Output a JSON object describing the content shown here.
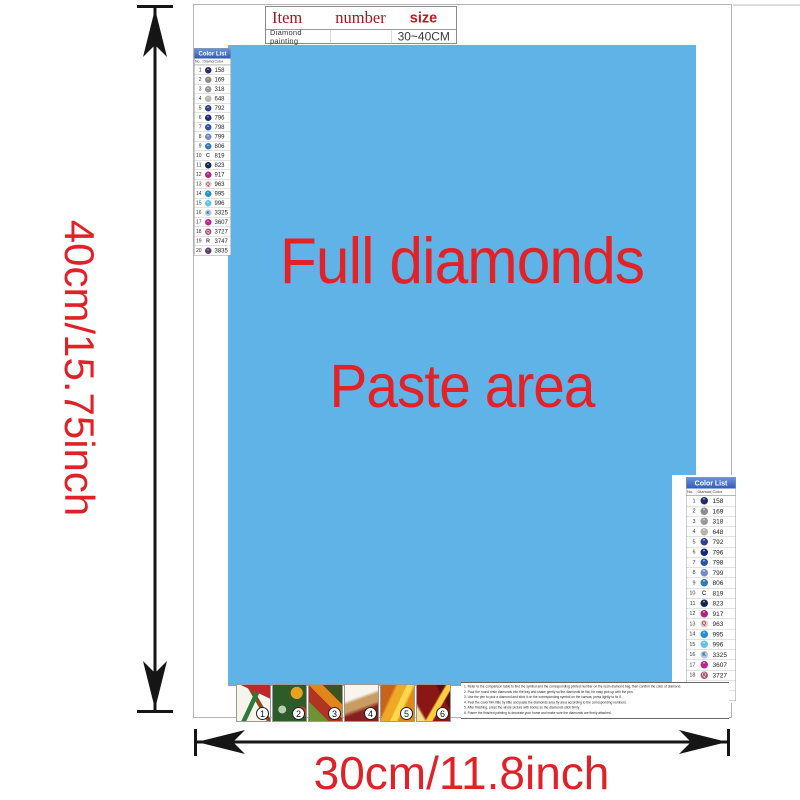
{
  "dimensions": {
    "height": "40cm/15.75inch",
    "width": "30cm/11.8inch"
  },
  "paste_area": {
    "line1": "Full diamonds",
    "line2": "Paste area"
  },
  "item_table": {
    "col_item": "Item",
    "col_number": "number",
    "col_size": "size",
    "row_name": "Diamond painting",
    "row_number": "",
    "row_size": "30~40CM"
  },
  "color_list": {
    "title": "Color List",
    "col_no": "No.",
    "col_symbol": "Diamond",
    "col_color": "Color",
    "rows": [
      {
        "no": "1",
        "code": "158",
        "fill": "#232d6e",
        "symbol": "*",
        "symbol_color": "#ffffff"
      },
      {
        "no": "2",
        "code": "169",
        "fill": "#8b8b8b",
        "symbol": "*",
        "symbol_color": "#ffffff"
      },
      {
        "no": "3",
        "code": "318",
        "fill": "#97979d",
        "symbol": "*",
        "symbol_color": "#ffffff"
      },
      {
        "no": "4",
        "code": "648",
        "fill": "#b4b4ac",
        "symbol": "*",
        "symbol_color": "#ffffff"
      },
      {
        "no": "5",
        "code": "792",
        "fill": "#333f8e",
        "symbol": "*",
        "symbol_color": "#ffffff"
      },
      {
        "no": "6",
        "code": "796",
        "fill": "#14297b",
        "symbol": "*",
        "symbol_color": "#ffffff"
      },
      {
        "no": "7",
        "code": "798",
        "fill": "#2a52a8",
        "symbol": "*",
        "symbol_color": "#ffffff"
      },
      {
        "no": "8",
        "code": "799",
        "fill": "#7389cc",
        "symbol": "*",
        "symbol_color": "#ffffff"
      },
      {
        "no": "9",
        "code": "806",
        "fill": "#2e7cb6",
        "symbol": "*",
        "symbol_color": "#ffffff"
      },
      {
        "no": "10",
        "code": "819",
        "fill": null,
        "symbol": "C",
        "symbol_color": "#444444"
      },
      {
        "no": "11",
        "code": "823",
        "fill": "#17244f",
        "symbol": "*",
        "symbol_color": "#ffffff"
      },
      {
        "no": "12",
        "code": "917",
        "fill": "#b02185",
        "symbol": "*",
        "symbol_color": "#ffffff"
      },
      {
        "no": "13",
        "code": "963",
        "fill": "#eec0c4",
        "symbol": "Q",
        "symbol_color": "#333333"
      },
      {
        "no": "14",
        "code": "995",
        "fill": "#1f8fd0",
        "symbol": "*",
        "symbol_color": "#ffffff"
      },
      {
        "no": "15",
        "code": "996",
        "fill": "#63c1e9",
        "symbol": "*",
        "symbol_color": "#ffffff"
      },
      {
        "no": "16",
        "code": "3325",
        "fill": "#a9c9ea",
        "symbol": "K",
        "symbol_color": "#222233"
      },
      {
        "no": "17",
        "code": "3607",
        "fill": "#c02290",
        "symbol": "*",
        "symbol_color": "#ffffff"
      },
      {
        "no": "18",
        "code": "3727",
        "fill": "#a85b70",
        "symbol": "Q",
        "symbol_color": "#ffffff"
      },
      {
        "no": "19",
        "code": "3747",
        "fill": null,
        "symbol": "R",
        "symbol_color": "#444444"
      },
      {
        "no": "20",
        "code": "3835",
        "fill": "#5e4070",
        "symbol": "*",
        "symbol_color": "#ffffff"
      }
    ]
  },
  "thumbnails": [
    {
      "label": "1"
    },
    {
      "label": "2"
    },
    {
      "label": "3"
    },
    {
      "label": "4"
    },
    {
      "label": "5"
    },
    {
      "label": "6"
    }
  ],
  "instructions": [
    "1. Refer to the comparison table to find the symbol and the corresponding printed number on the resin diamond bag, then confirm the color of diamond.",
    "2. Pour the round resin diamonds into the tray and shake gently so the diamonds lie flat, for easy pick up with the pen.",
    "3. Use the pen to pick a diamond and stick it on the corresponding symbol on the canvas; press lightly to fix it.",
    "4. Peel the cover film little by little and paste the diamonds area by area according to the corresponding numbers.",
    "5. After finishing, press the whole picture with books so the diamonds stick firmly.",
    "6. Frame the finished painting to decorate your home and make sure the diamonds are firmly attached."
  ],
  "colors": {
    "paste_bg": "#60b3e7",
    "accent_red": "#e32227",
    "dim_red": "#e02228",
    "item_header_red": "#9e1b20",
    "size_red": "#c9151d",
    "list_header_bg": "#3a6cc6"
  }
}
